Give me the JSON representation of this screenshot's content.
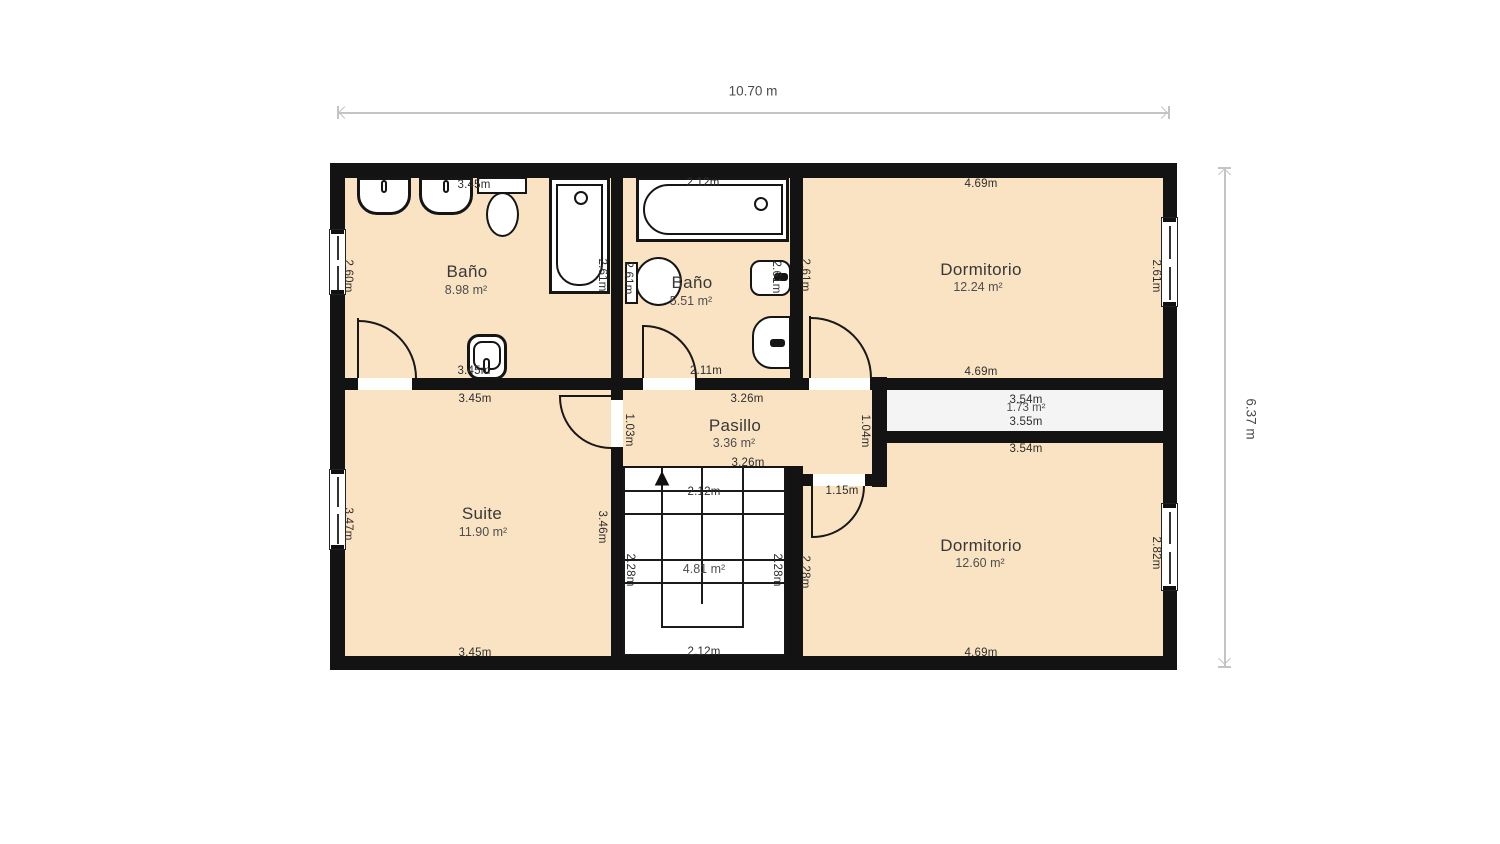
{
  "plan": {
    "colors": {
      "room": "#fae3c2",
      "wall": "#131313",
      "stair": "#ffffff",
      "closet": "#f4f4f4",
      "fixture": "#ffffff",
      "fxborder": "#151515",
      "dimline": "#c4c4c4",
      "dimtext": "#4a4a4a",
      "label": "#2d2d2d",
      "name": "#383838",
      "area": "#4e4e4e"
    },
    "total_width_label": "10.70 m",
    "total_height_label": "6.37 m"
  },
  "symbols": {
    "stairs_up_arrow": "▲"
  },
  "rooms": {
    "bano1": {
      "name": "Baño",
      "area": "8.98 m²",
      "dim_top": "3.45m",
      "dim_bottom": "3.45m",
      "dim_left": "2.60m",
      "dim_right": "2.61m"
    },
    "bano2": {
      "name": "Baño",
      "area": "5.51 m²",
      "dim_top": "2.12m",
      "dim_bottom": "2.11m",
      "dim_left": "2.61m",
      "dim_right": "2.61m"
    },
    "dormitorio1": {
      "name": "Dormitorio",
      "area": "12.24 m²",
      "dim_top": "4.69m",
      "dim_bottom": "4.69m",
      "dim_left": "2.61m",
      "dim_right": "2.61m"
    },
    "suite": {
      "name": "Suite",
      "area": "11.90 m²",
      "dim_top": "3.45m",
      "dim_bottom": "3.45m",
      "dim_left": "3.47m",
      "dim_right": "3.46m"
    },
    "pasillo": {
      "name": "Pasillo",
      "area": "3.36 m²",
      "dim_top": "3.26m",
      "dim_bottom": "3.26m",
      "dim_left": "1.03m",
      "dim_right": "1.04m"
    },
    "escalera": {
      "area": "4.81 m²",
      "dim_top": "2.12m",
      "dim_bottom": "2.12m",
      "dim_left": "2.28m",
      "dim_right": "2.28m"
    },
    "armario": {
      "area": "1.73 m²",
      "dim_top": "3.54m",
      "dim_bottom": "3.55m"
    },
    "dormitorio2": {
      "name": "Dormitorio",
      "area": "12.60 m²",
      "dim_top": "3.54m",
      "dim_door": "1.15m",
      "dim_left": "2.28m",
      "dim_right": "2.82m",
      "dim_bottom": "4.69m"
    }
  }
}
